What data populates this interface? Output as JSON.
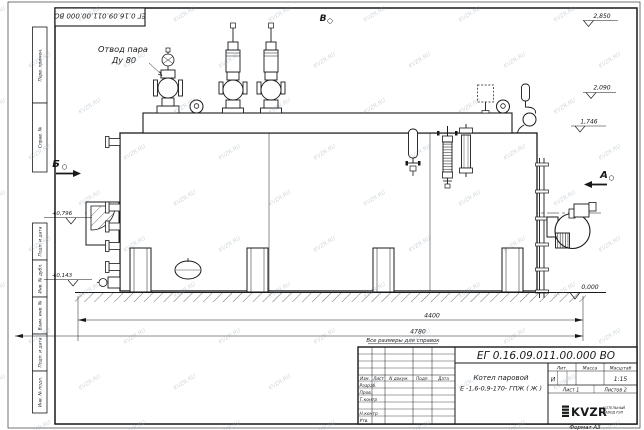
{
  "doc_number": "ЕГ 0.16.09.011.00.000  ВО",
  "watermark": {
    "text": "KVZR.RU"
  },
  "callouts": {
    "steam_outlet_line1": "Отвод пара",
    "steam_outlet_line2": "Ду 80"
  },
  "views": {
    "a": "А",
    "b": "Б",
    "v": "В"
  },
  "elevations": {
    "top1": "2,850",
    "top2": "2,090",
    "top3": "1,746",
    "ground": "0,000",
    "front_upper": "+0,796",
    "front_lower": "+0,143"
  },
  "dimensions": {
    "shell_length": "4400",
    "overall_length": "4780"
  },
  "note": "Все размеры для справок",
  "margin_stamps": {
    "perv_primen": "Перв. примен.",
    "sprav_no": "Справ. №",
    "podp_data_1": "Подп. и дата",
    "inv_dubl": "Инв. № дубл.",
    "vzam_inv": "Взам. инв. №",
    "podp_data_2": "Подп. и дата",
    "inv_podl": "Инв. № подл."
  },
  "title_block": {
    "product_name_line1": "Котел паровой",
    "product_name_line2": "Е -1,6-0,9-170- ГПЖ ( Ж )",
    "header_izm": "Изм.",
    "header_list": "Лист",
    "header_ndoc": "N докум.",
    "header_podp": "Подп.",
    "header_data": "Дата",
    "row_razrab": "Разраб.",
    "row_prov": "Пров.",
    "row_tkontr": "Т.контр",
    "row_nkontr": "Н.контр",
    "row_utv": "Утв.",
    "lit_header": "Лит.",
    "massa_header": "Масса",
    "masshtab_header": "Масштаб",
    "lit_value": "И",
    "scale_value": "1:15",
    "sheet": "Лист 1",
    "sheets": "Листов  2",
    "logo": "KVZR",
    "logo_sub1": "КОТЕЛЬНЫЙ",
    "logo_sub2": "ЗАВОД РЭП",
    "format": "Формат А3"
  }
}
